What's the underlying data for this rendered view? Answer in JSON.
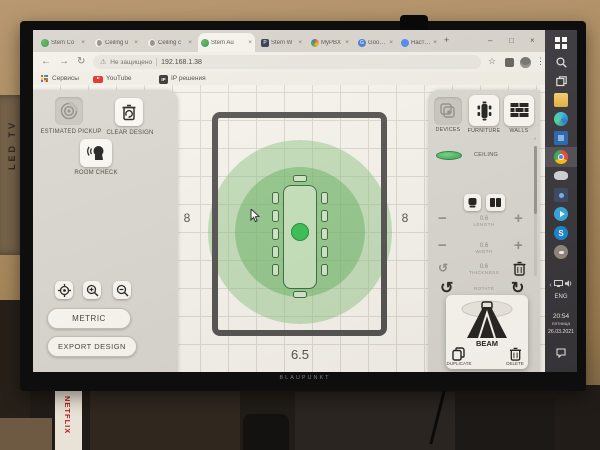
{
  "scene": {
    "monitor_brand": "BLAUPUNKT",
    "netflix_box": "NETFLIX",
    "tv_box": "LED TV"
  },
  "browser": {
    "tabs": [
      {
        "title": "Stem Co"
      },
      {
        "title": "Ceiling u"
      },
      {
        "title": "Ceiling c"
      },
      {
        "title": "Stem Au"
      },
      {
        "title": "Stem W"
      },
      {
        "title": "MyPBX"
      },
      {
        "title": "Google"
      },
      {
        "title": "Настрой"
      }
    ],
    "close_glyph": "×",
    "new_tab_glyph": "+",
    "controls": {
      "min": "–",
      "max": "□",
      "close": "×"
    },
    "nav": {
      "back": "←",
      "forward": "→",
      "reload": "↻"
    },
    "address": {
      "warning_icon": "⚠",
      "warning_label": "Не защищено",
      "url": "192.168.1.38"
    },
    "toolbar_icons": {
      "star": "☆",
      "menu": "⋮"
    },
    "bookmarks": {
      "services": "Сервисы",
      "youtube": "YouTube",
      "ip": "IP решения",
      "ip_badge": "IP"
    }
  },
  "app": {
    "left": {
      "estimated_pickup": "ESTIMATED PICKUP",
      "clear_design": "CLEAR DESIGN",
      "room_check": "ROOM CHECK",
      "metric": "METRIC",
      "export_design": "EXPORT DESIGN"
    },
    "canvas": {
      "left_dim": "8",
      "right_dim": "8",
      "bottom_dim": "6.5"
    },
    "right": {
      "tabs": [
        {
          "label": "DEVICES"
        },
        {
          "label": "FURNITURE"
        },
        {
          "label": "WALLS"
        }
      ],
      "ceiling_item": "CEILING",
      "length": {
        "value": "0.6",
        "label": "LENGTH"
      },
      "width": {
        "value": "0.6",
        "label": "WIDTH"
      },
      "thickness": {
        "value": "0.6",
        "label": "THICKNESS"
      },
      "rotate_label": "ROTATE",
      "beam": {
        "name": "BEAM",
        "duplicate": "DUPLICATE",
        "delete": "DELETE"
      }
    },
    "glyphs": {
      "minus": "−",
      "plus": "+",
      "rotate_ccw": "↺",
      "rotate_cw": "↻",
      "scroll_up": "^"
    }
  },
  "taskbar": {
    "language": "ENG",
    "time": "20:54",
    "weekday": "пятница",
    "date": "26.03.2021",
    "tray_chevron": "‹"
  },
  "colors": {
    "device_green": "#2fbf4e",
    "coverage_inner": "rgba(96,176,92,0.50)",
    "coverage_outer": "rgba(126,192,120,0.45)",
    "panel_grey": "#d9d7d2"
  }
}
